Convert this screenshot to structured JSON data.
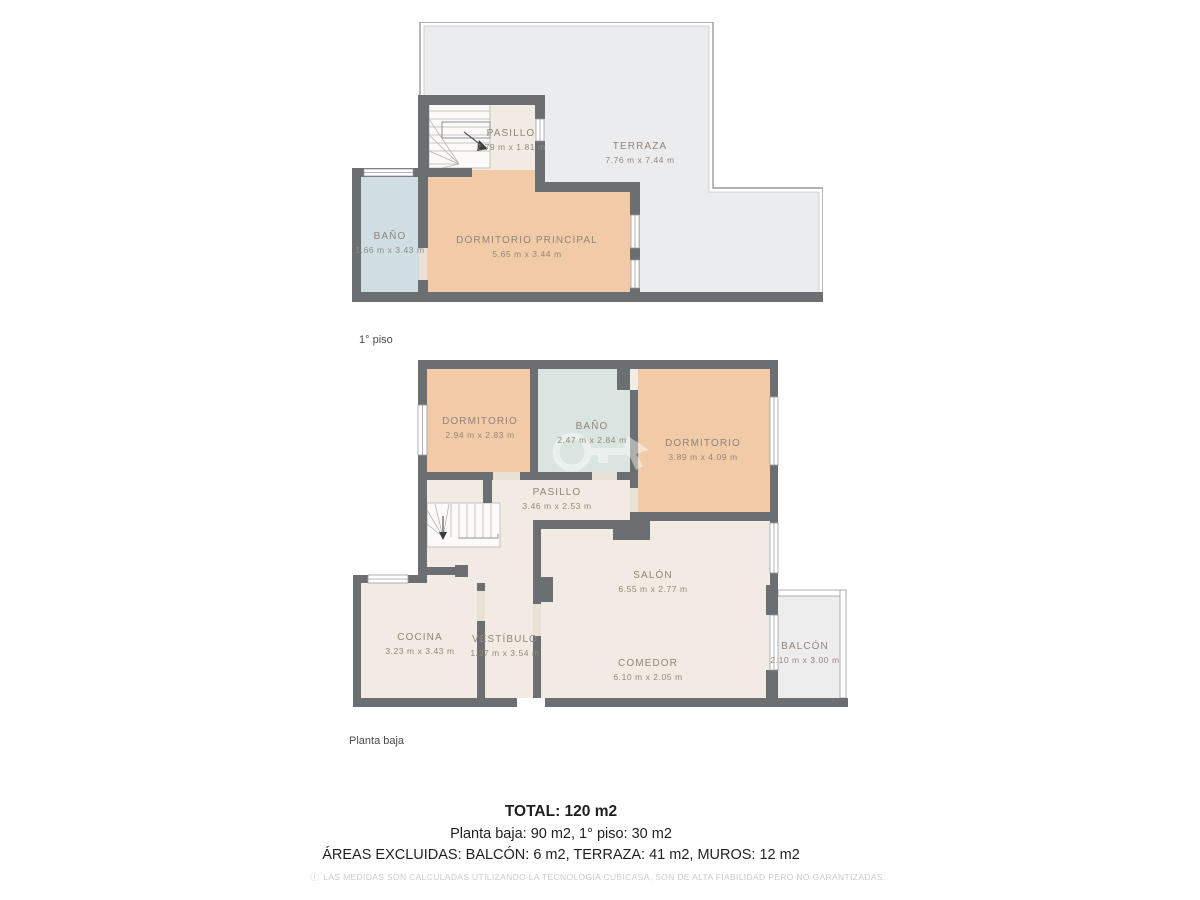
{
  "palette": {
    "wall": "#6c6f71",
    "floor": "#f1ebe3",
    "bedroom": "#f1caa7",
    "bath_upper": "#cfdee3",
    "bath_lower": "#dae4e1",
    "terrace": "#ebeced",
    "label_text": "#92857a",
    "outline": "#97999c",
    "summary_text": "#1f1f1f",
    "disclaimer_text": "#c9cbcc"
  },
  "floors": [
    {
      "label": "1° piso",
      "rooms": [
        {
          "name": "PASILLO",
          "dims": "2.79 m x 1.81 m"
        },
        {
          "name": "TERRAZA",
          "dims": "7.76 m x 7.44 m"
        },
        {
          "name": "BAÑO",
          "dims": "1.66 m x 3.43 m"
        },
        {
          "name": "DORMITORIO PRINCIPAL",
          "dims": "5.65 m x 3.44 m"
        }
      ]
    },
    {
      "label": "Planta baja",
      "rooms": [
        {
          "name": "DORMITORIO",
          "dims": "2.94 m x 2.83 m"
        },
        {
          "name": "BAÑO",
          "dims": "2.47 m x 2.84 m"
        },
        {
          "name": "DORMITORIO",
          "dims": "3.89 m x 4.09 m"
        },
        {
          "name": "PASILLO",
          "dims": "3.46 m x 2.53 m"
        },
        {
          "name": "COCINA",
          "dims": "3.23 m x 3.43 m"
        },
        {
          "name": "VESTÍBULO",
          "dims": "1.27 m x 3.54 m"
        },
        {
          "name": "SALÓN",
          "dims": "6.55 m x 2.77 m"
        },
        {
          "name": "COMEDOR",
          "dims": "6.10 m x 2.05 m"
        },
        {
          "name": "BALCÓN",
          "dims": "2.10 m x 3.00 m"
        }
      ]
    }
  ],
  "summary": {
    "total": "TOTAL: 120 m2",
    "breakdown": "Planta baja: 90 m2, 1° piso: 30 m2",
    "excluded": "ÁREAS EXCLUIDAS: BALCÓN: 6 m2, TERRAZA: 41 m2, MUROS: 12 m2",
    "disclaimer": "LAS MEDIDAS SON CALCULADAS UTILIZANDO LA TECNOLOGÍA CUBICASA, SON DE ALTA FIABILIDAD PERO NO GARANTIZADAS.",
    "disclaimer_icon": "ⓘ"
  }
}
